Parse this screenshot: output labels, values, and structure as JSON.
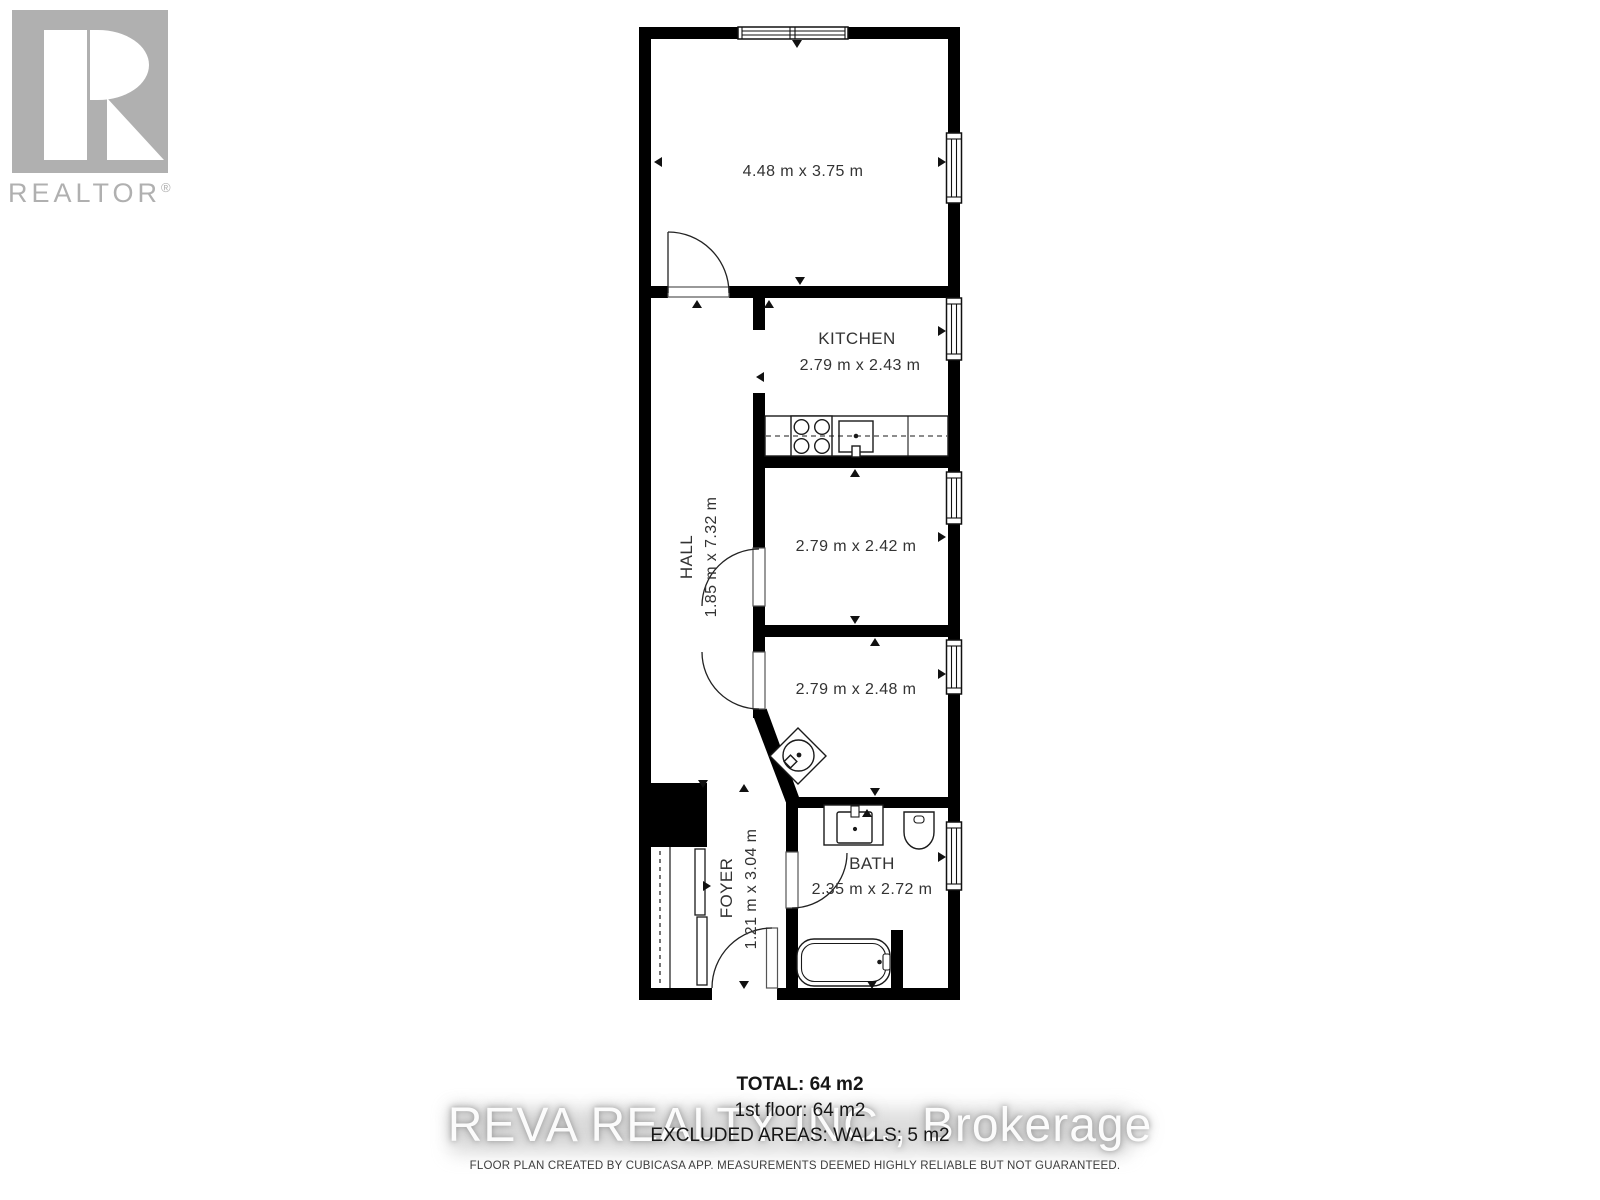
{
  "logo": {
    "brand": "REALTOR",
    "registered": "®"
  },
  "colors": {
    "wall": "#000000",
    "logo_gray": "#b0b0b0",
    "label_text": "#333333",
    "watermark_gray": "#c9c9c9"
  },
  "floorplan": {
    "rooms": {
      "main": {
        "dims": "4.48 m x 3.75 m"
      },
      "kitchen": {
        "name": "KITCHEN",
        "dims": "2.79 m x 2.43 m"
      },
      "hall": {
        "name": "HALL",
        "dims": "1.85 m x 7.32 m"
      },
      "bedroom2": {
        "dims": "2.79 m x 2.42 m"
      },
      "bedroom3": {
        "dims": "2.79 m x 2.48 m"
      },
      "bath": {
        "name": "BATH",
        "dims": "2.35 m x 2.72 m"
      },
      "foyer": {
        "name": "FOYER",
        "dims": "1.21 m x 3.04 m"
      }
    }
  },
  "summary": {
    "total": "TOTAL: 64 m2",
    "first_floor": "1st floor: 64 m2",
    "excluded": "EXCLUDED AREAS: WALLS: 5 m2"
  },
  "watermark": "REVA REALTY INC., Brokerage",
  "footer": "FLOOR PLAN CREATED BY CUBICASA APP. MEASUREMENTS DEEMED HIGHLY RELIABLE BUT NOT GUARANTEED."
}
